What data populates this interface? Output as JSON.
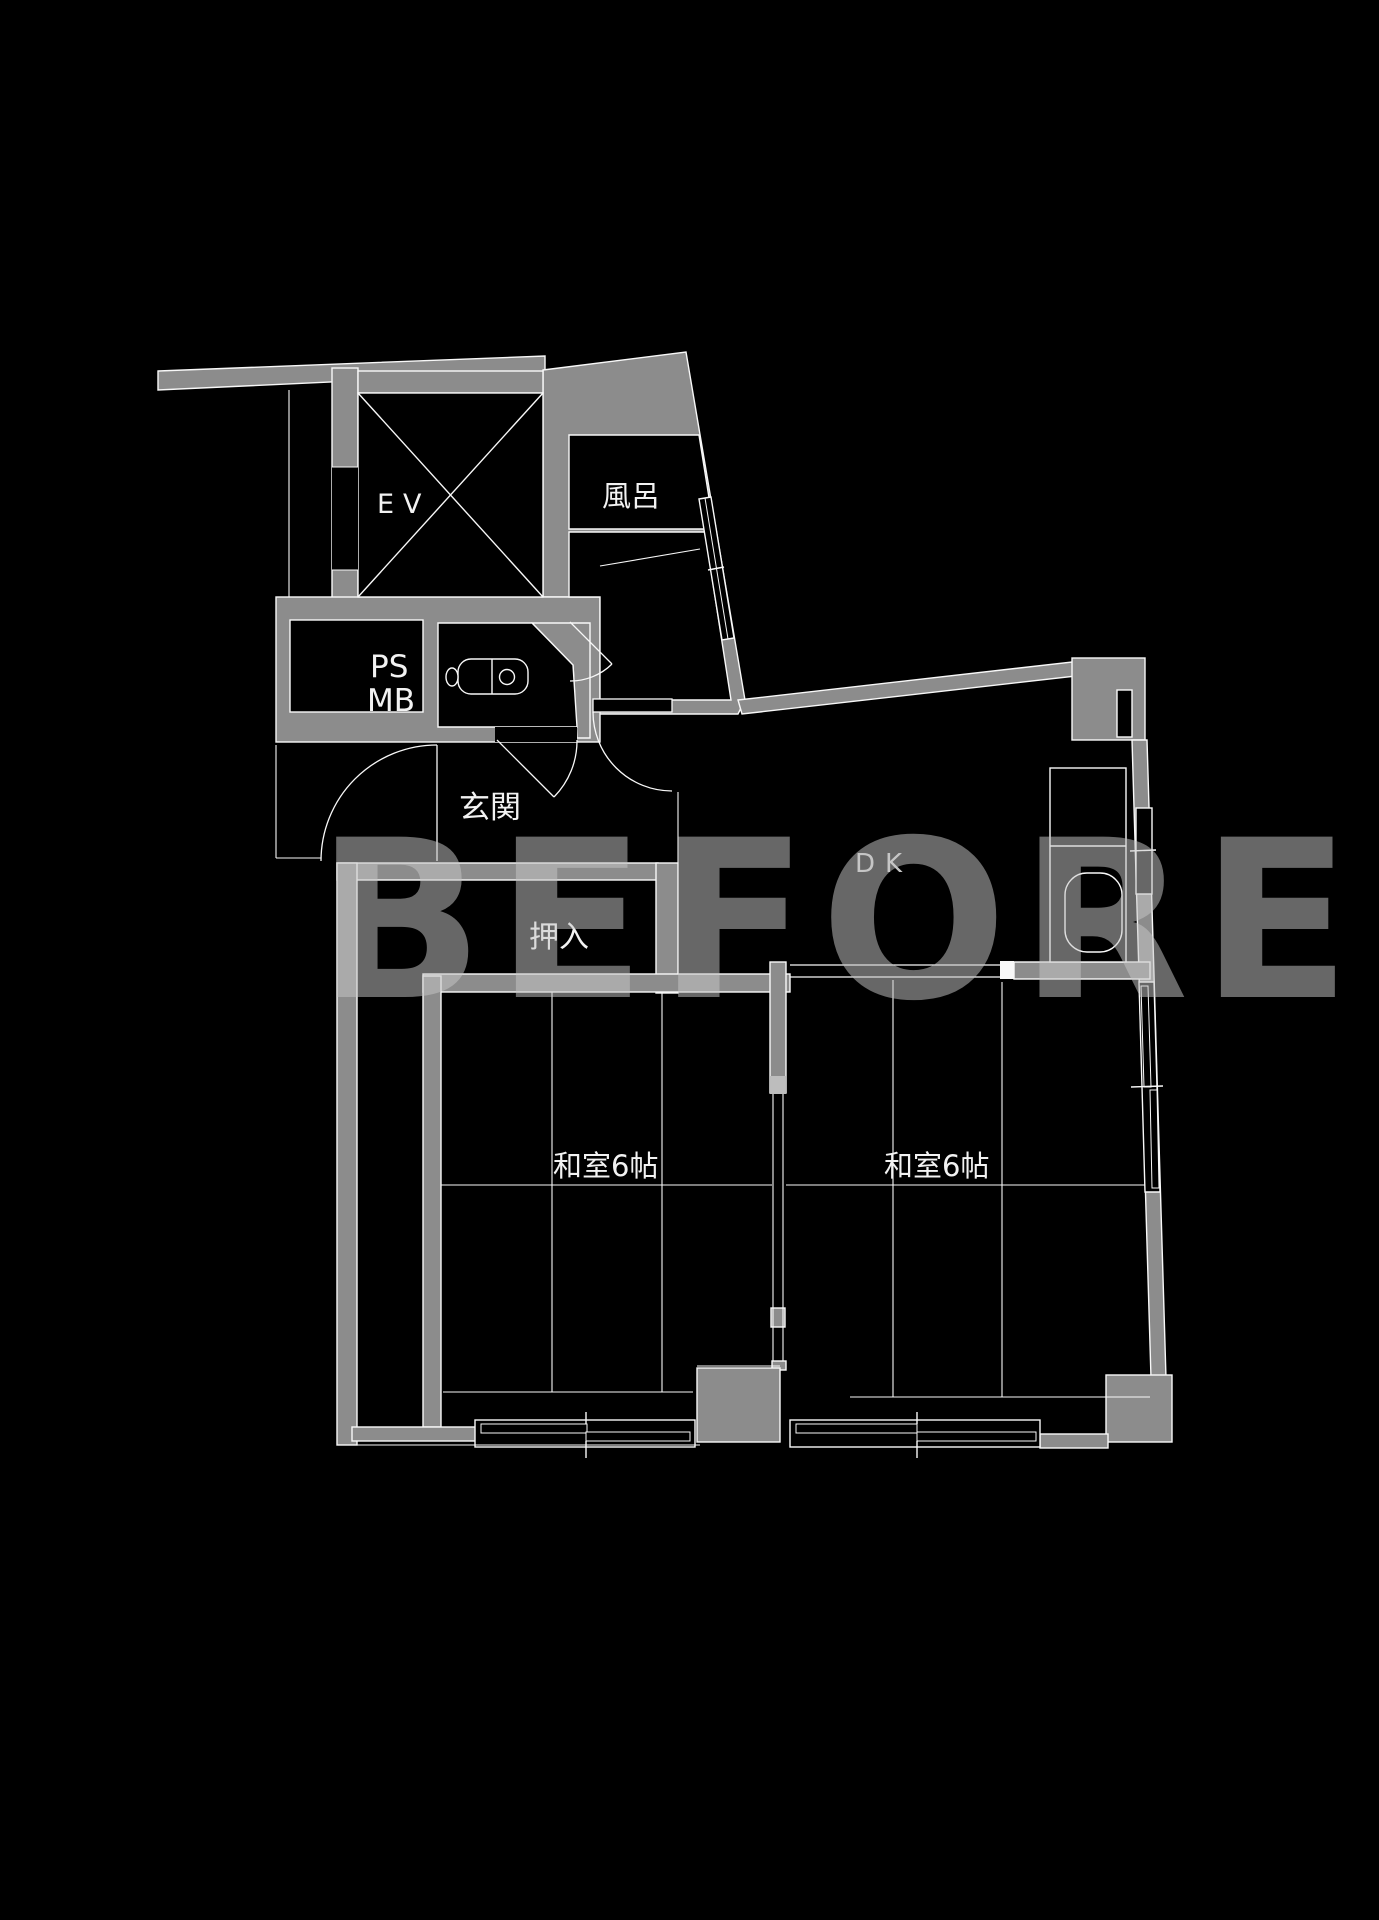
{
  "watermark": {
    "text": "BEFORE",
    "color": "#c6c6c6"
  },
  "floor_plan": {
    "rooms": [
      {
        "id": "elevator",
        "label": "EV"
      },
      {
        "id": "bath",
        "label": "風呂"
      },
      {
        "id": "pipe-space",
        "label": "PS"
      },
      {
        "id": "meter-box",
        "label": "MB"
      },
      {
        "id": "entrance",
        "label": "玄関"
      },
      {
        "id": "closet",
        "label": "押入"
      },
      {
        "id": "dining-kitchen",
        "label": "DK"
      },
      {
        "id": "japanese-room-left",
        "label": "和室6帖"
      },
      {
        "id": "japanese-room-right",
        "label": "和室6帖"
      }
    ],
    "colors": {
      "background": "#000000",
      "wall_fill": "#8c8c8c",
      "line": "#f8f8f8",
      "label_text": "#f2f2f2",
      "dk_label_text": "#c6c6c6",
      "watermark": "#c6c6c6"
    }
  }
}
